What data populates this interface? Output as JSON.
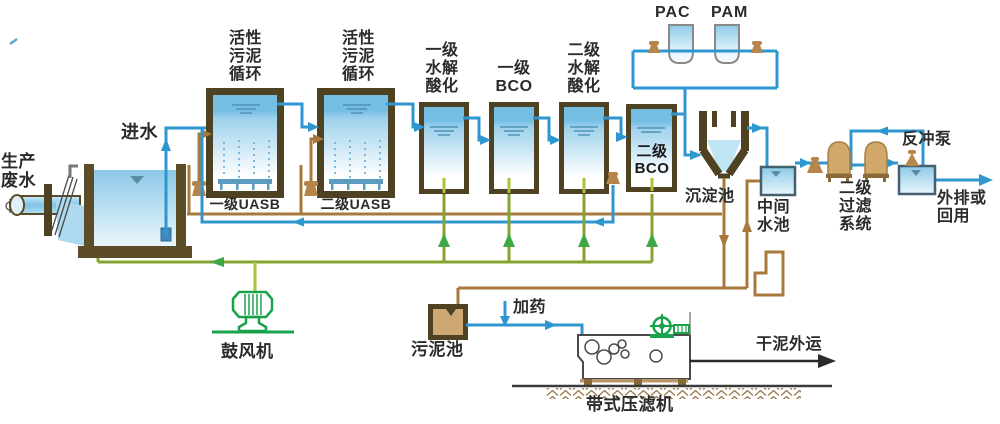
{
  "diagram": {
    "labels": {
      "prod_wastewater": "生产\n废水",
      "inlet": "进水",
      "sludge_cycle": "活性\n污泥\n循环",
      "uasb1": "一级UASB",
      "uasb2": "二级UASB",
      "hydrolysis1": "一级\n水解\n酸化",
      "bco1": "一级\nBCO",
      "hydrolysis2": "二级\n水解\n酸化",
      "bco2": "二级\nBCO",
      "pac": "PAC",
      "pam": "PAM",
      "sedimentation": "沉淀池",
      "mid_tank": "中间\n水池",
      "filter_system": "二级\n过滤\n系统",
      "backwash_pump": "反冲泵",
      "outfall": "外排或\n回用",
      "blower": "鼓风机",
      "sludge_tank": "污泥池",
      "dosing": "加药",
      "dry_sludge": "干泥外运",
      "belt_press": "带式压滤机"
    },
    "legend_colors": {
      "water_pipe": "#2f97d0",
      "sludge_pipe": "#a8793c",
      "air_pipe": "#84a32f",
      "equipment_green": "#18a34b",
      "tank_wall": "#4f4223",
      "filter_vessel": "#d2a86a"
    }
  }
}
